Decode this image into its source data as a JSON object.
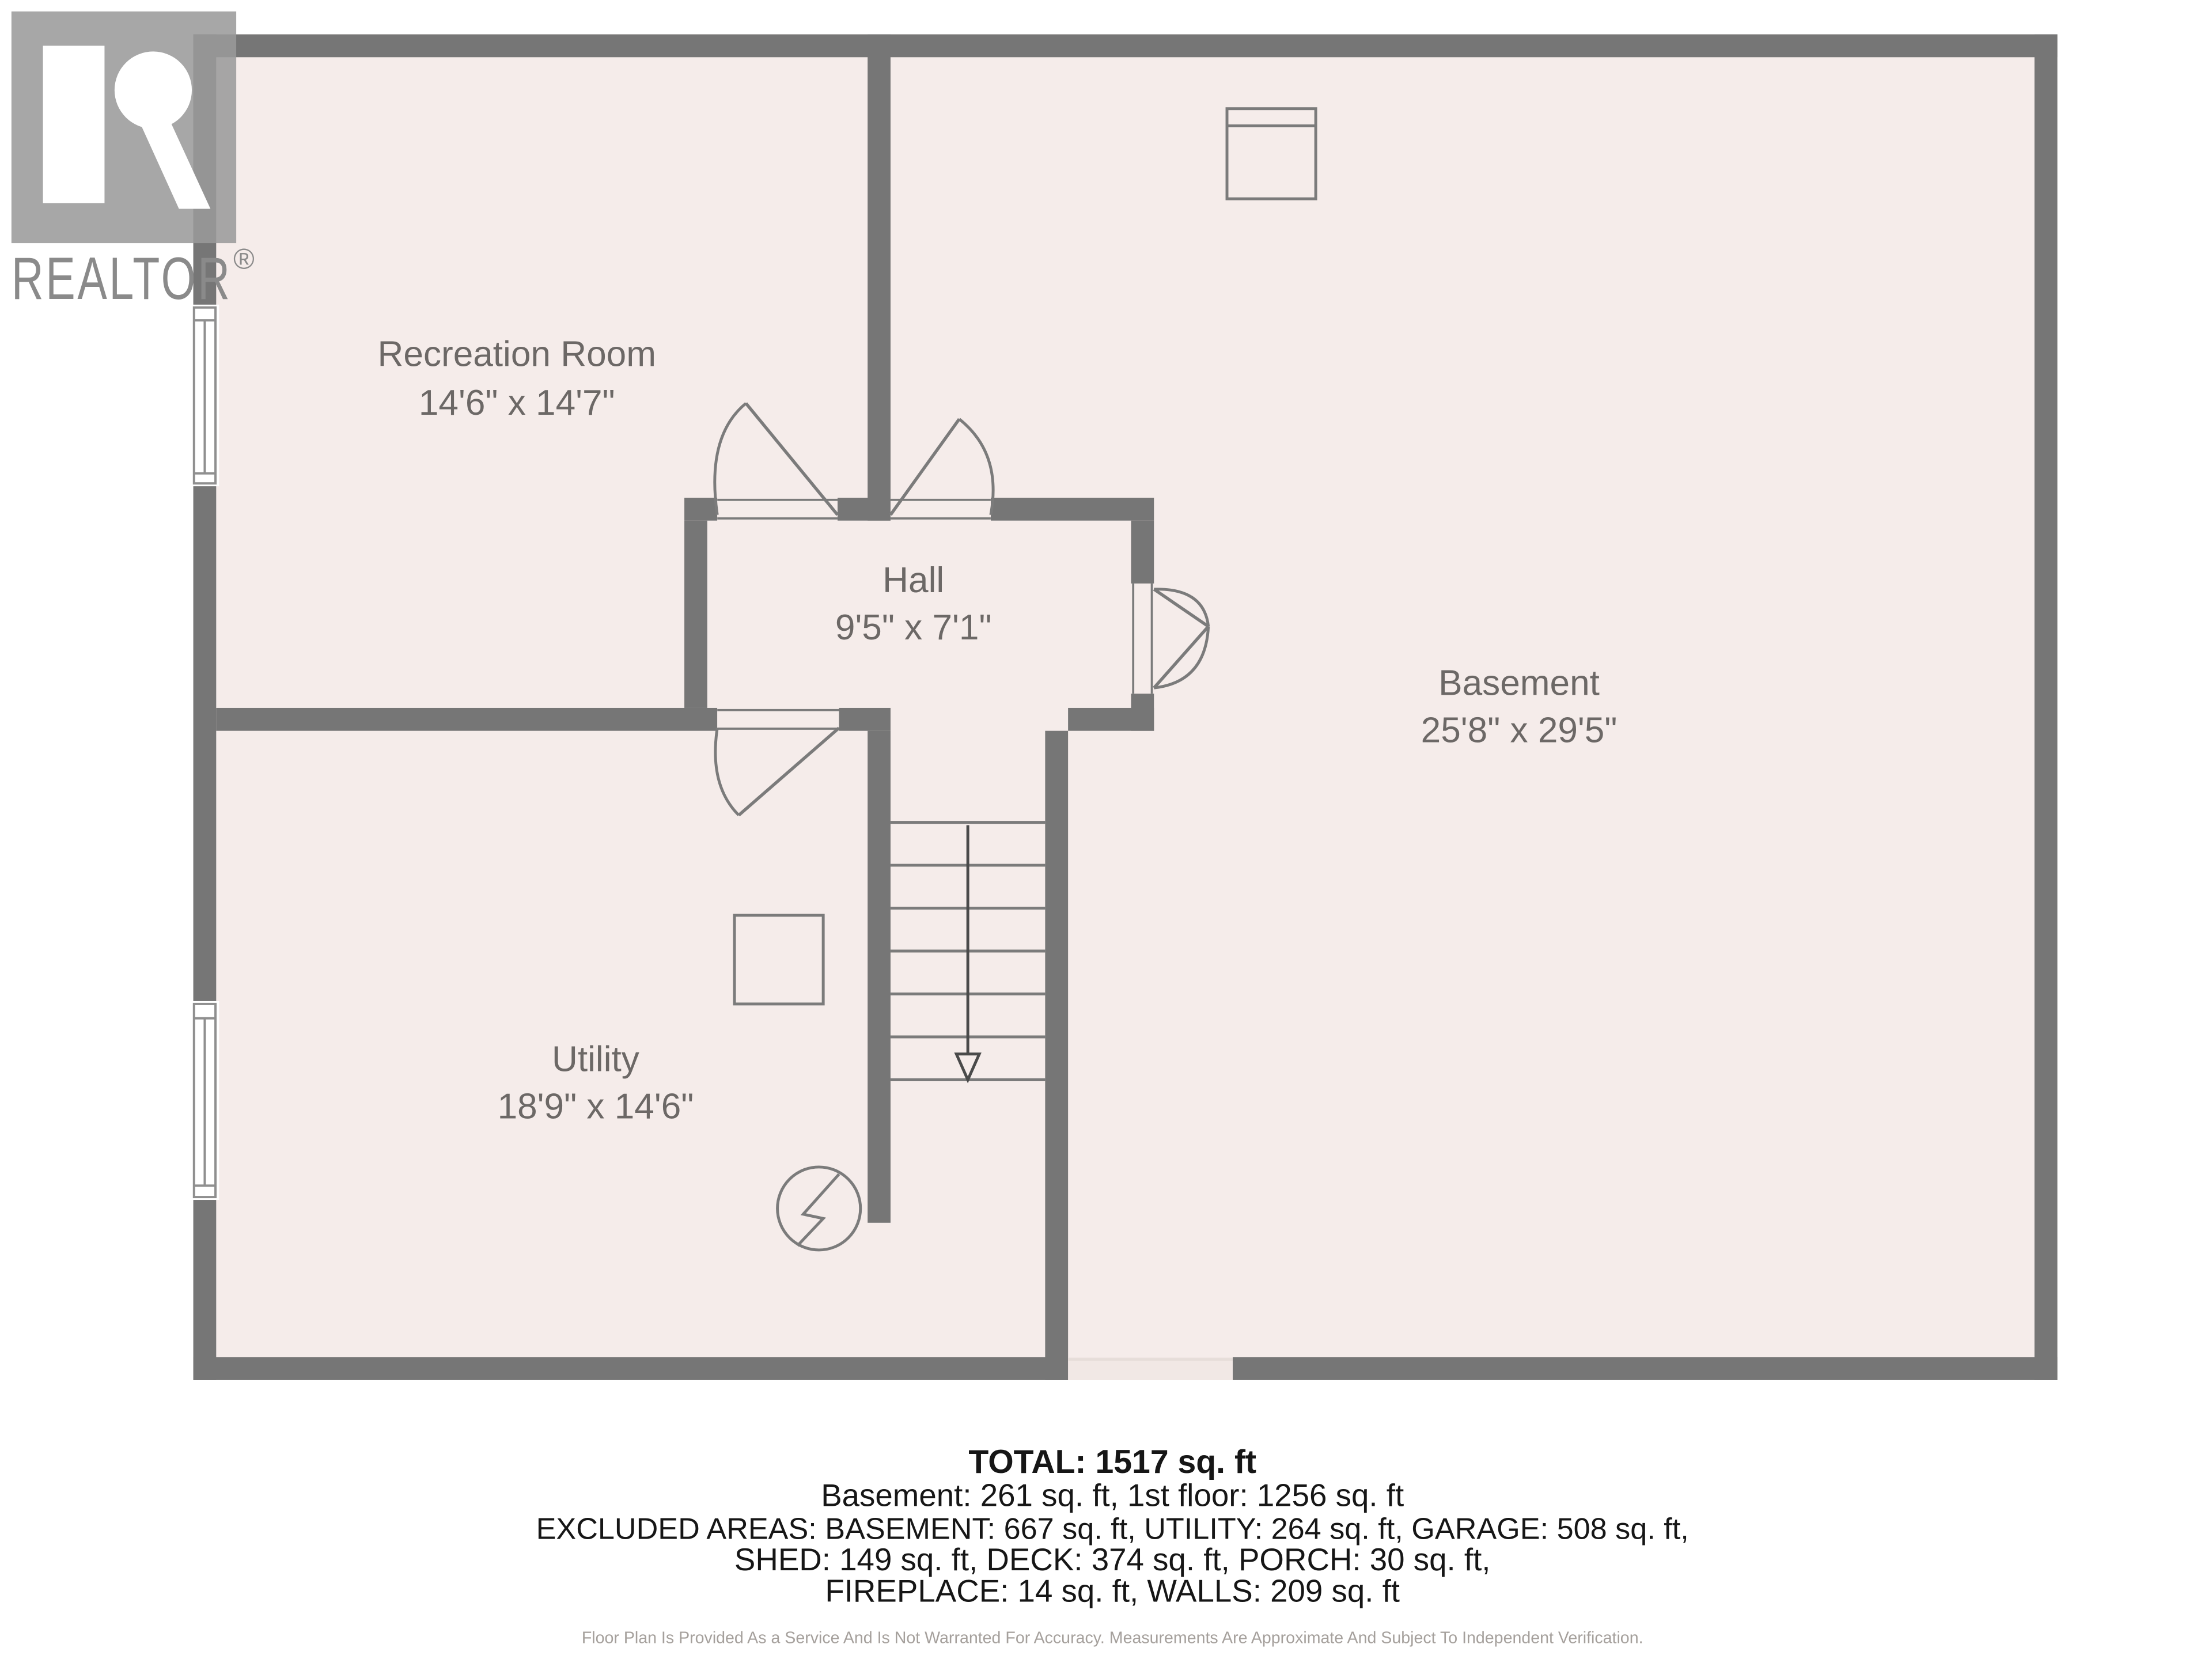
{
  "branding": {
    "logo_text": "REALTOR",
    "registered_mark": "®"
  },
  "rooms": [
    {
      "name": "Recreation Room",
      "dims": "14'6\" x 14'7\""
    },
    {
      "name": "Hall",
      "dims": "9'5\" x 7'1\""
    },
    {
      "name": "Basement",
      "dims": "25'8\" x 29'5\""
    },
    {
      "name": "Utility",
      "dims": "18'9\" x 14'6\""
    }
  ],
  "summary": {
    "total": "TOTAL: 1517 sq. ft",
    "floors": "Basement: 261 sq. ft, 1st floor: 1256 sq. ft",
    "excluded1": "EXCLUDED AREAS: BASEMENT: 667 sq. ft, UTILITY: 264 sq. ft, GARAGE: 508 sq. ft,",
    "excluded2": "SHED: 149 sq. ft, DECK: 374 sq. ft, PORCH: 30 sq. ft,",
    "excluded3": "FIREPLACE: 14 sq. ft, WALLS: 209 sq. ft"
  },
  "disclaimer": "Floor Plan Is Provided As a Service And Is Not Warranted For Accuracy. Measurements Are Approximate And Subject To Independent Verification.",
  "colors": {
    "wall": "#767676",
    "floor": "#f5ecea",
    "thin_line": "#7b7b7b",
    "room_text": "#6c6866",
    "summary_text": "#161616",
    "disclaimer_text": "#a5a09c",
    "logo_gray": "#9a9a9a",
    "logo_text_gray": "#8a8a8a"
  },
  "symbols": {
    "stairs": "stairs-down-arrow",
    "doors": "door-swing",
    "electrical": "electrical-outlet-symbol",
    "fireplace": "fireplace-box",
    "windows": "window-double-line"
  }
}
